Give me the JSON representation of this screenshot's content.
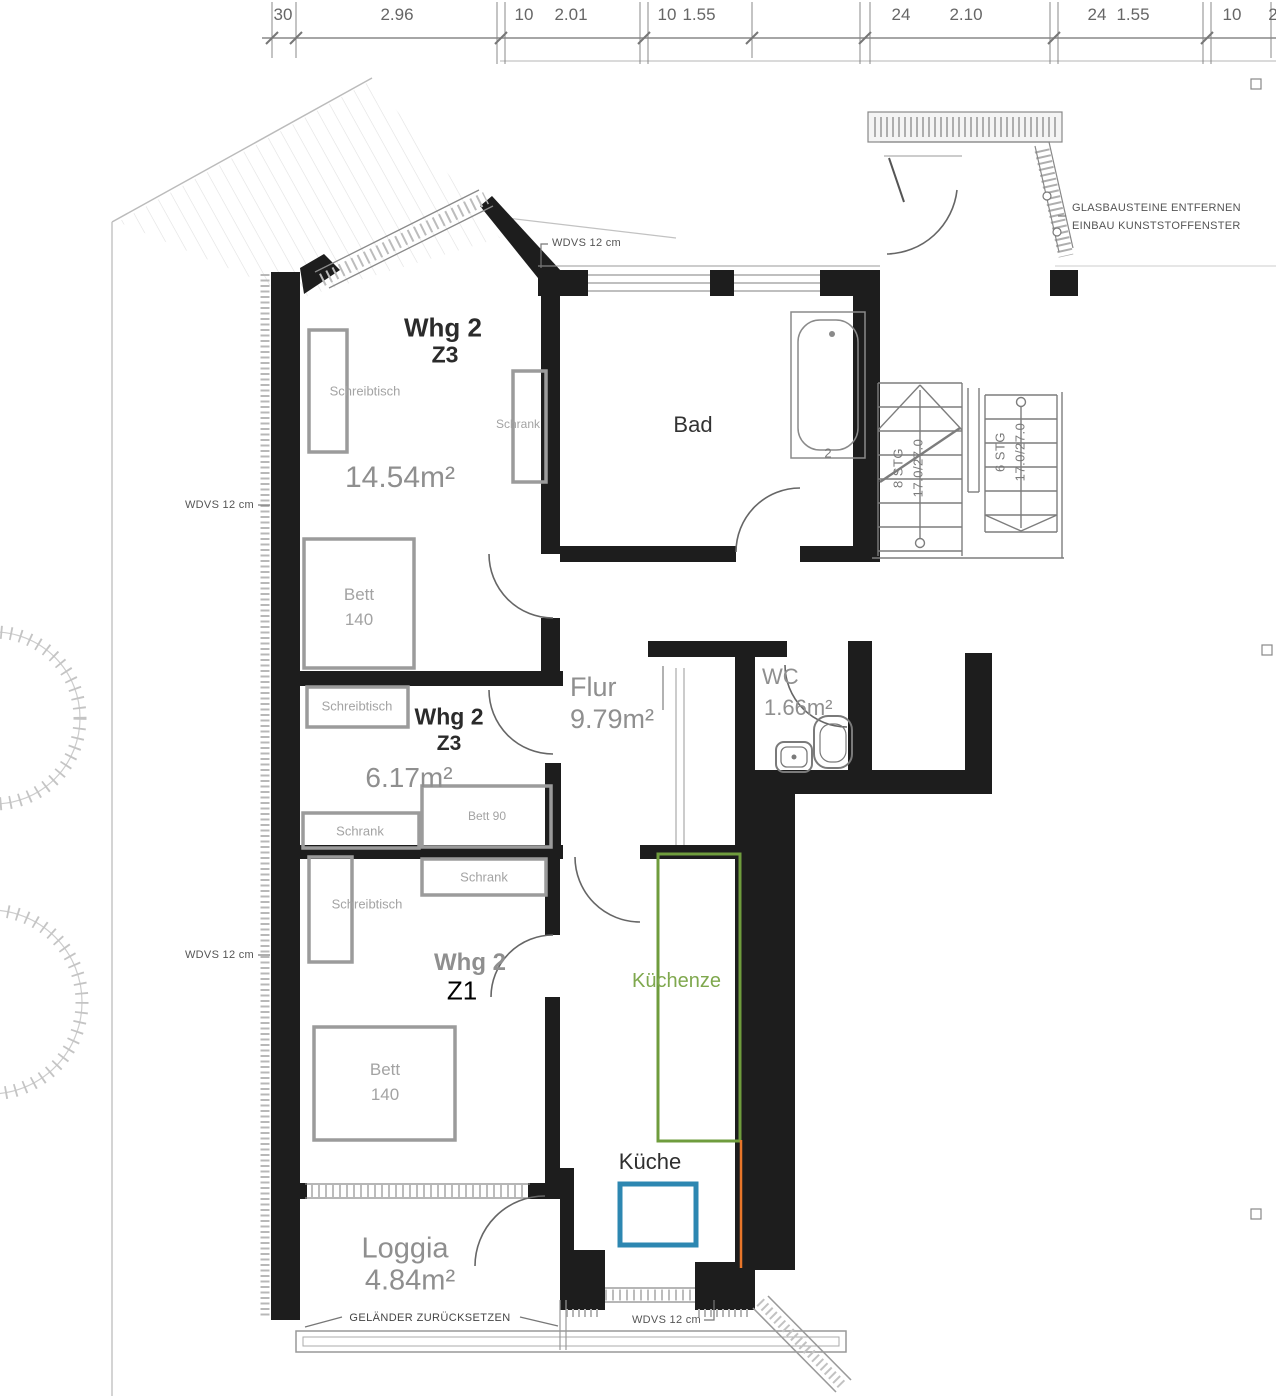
{
  "dimension_row": {
    "labels": [
      "30",
      "2.96",
      "10",
      "2.01",
      "10",
      "1.55",
      "24",
      "2.10",
      "24",
      "1.55",
      "10",
      "2"
    ]
  },
  "annotations": {
    "wdvs": "WDVS 12 cm",
    "glass_note_line1": "GLASBAUSTEINE ENTFERNEN",
    "glass_note_line2": "EINBAU KUNSTSTOFFENSTER",
    "railing_note": "GELÄNDER ZURÜCKSETZEN"
  },
  "rooms": {
    "room_top": {
      "label": "Whg 2",
      "unit": "Z3",
      "area": "14.54m²",
      "desk": "Schreibtisch",
      "wardrobe": "Schrank",
      "bed_line1": "Bett",
      "bed_line2": "140"
    },
    "room_mid": {
      "label": "Whg 2",
      "unit": "Z3",
      "area": "6.17m²",
      "desk": "Schreibtisch",
      "wardrobe": "Schrank",
      "bed": "Bett 90"
    },
    "room_z1": {
      "label": "Whg 2",
      "unit": "Z1",
      "desk": "Schreibtisch",
      "wardrobe": "Schrank",
      "bed_line1": "Bett",
      "bed_line2": "140"
    },
    "bad": {
      "label": "Bad",
      "tub_mark": "2"
    },
    "flur": {
      "label": "Flur",
      "area": "9.79m²"
    },
    "wc": {
      "label": "WC",
      "area": "1.66m²"
    },
    "kitchen": {
      "label": "Küche",
      "unit_label": "Küchenze"
    },
    "loggia": {
      "label": "Loggia",
      "area": "4.84m²"
    }
  },
  "stairs": {
    "run_a_line1": "8 STG",
    "run_a_line2": "17.0/27.0",
    "run_b_line1": "6 STG",
    "run_b_line2": "17.0/27.0"
  },
  "colors": {
    "wall": "#1d1d1d",
    "furniture_gray": "#9b9b9b",
    "kitchen_unit_green": "#6f9c3d",
    "kitchen_block_blue": "#2d87b1",
    "accent_orange": "#e8762a"
  }
}
